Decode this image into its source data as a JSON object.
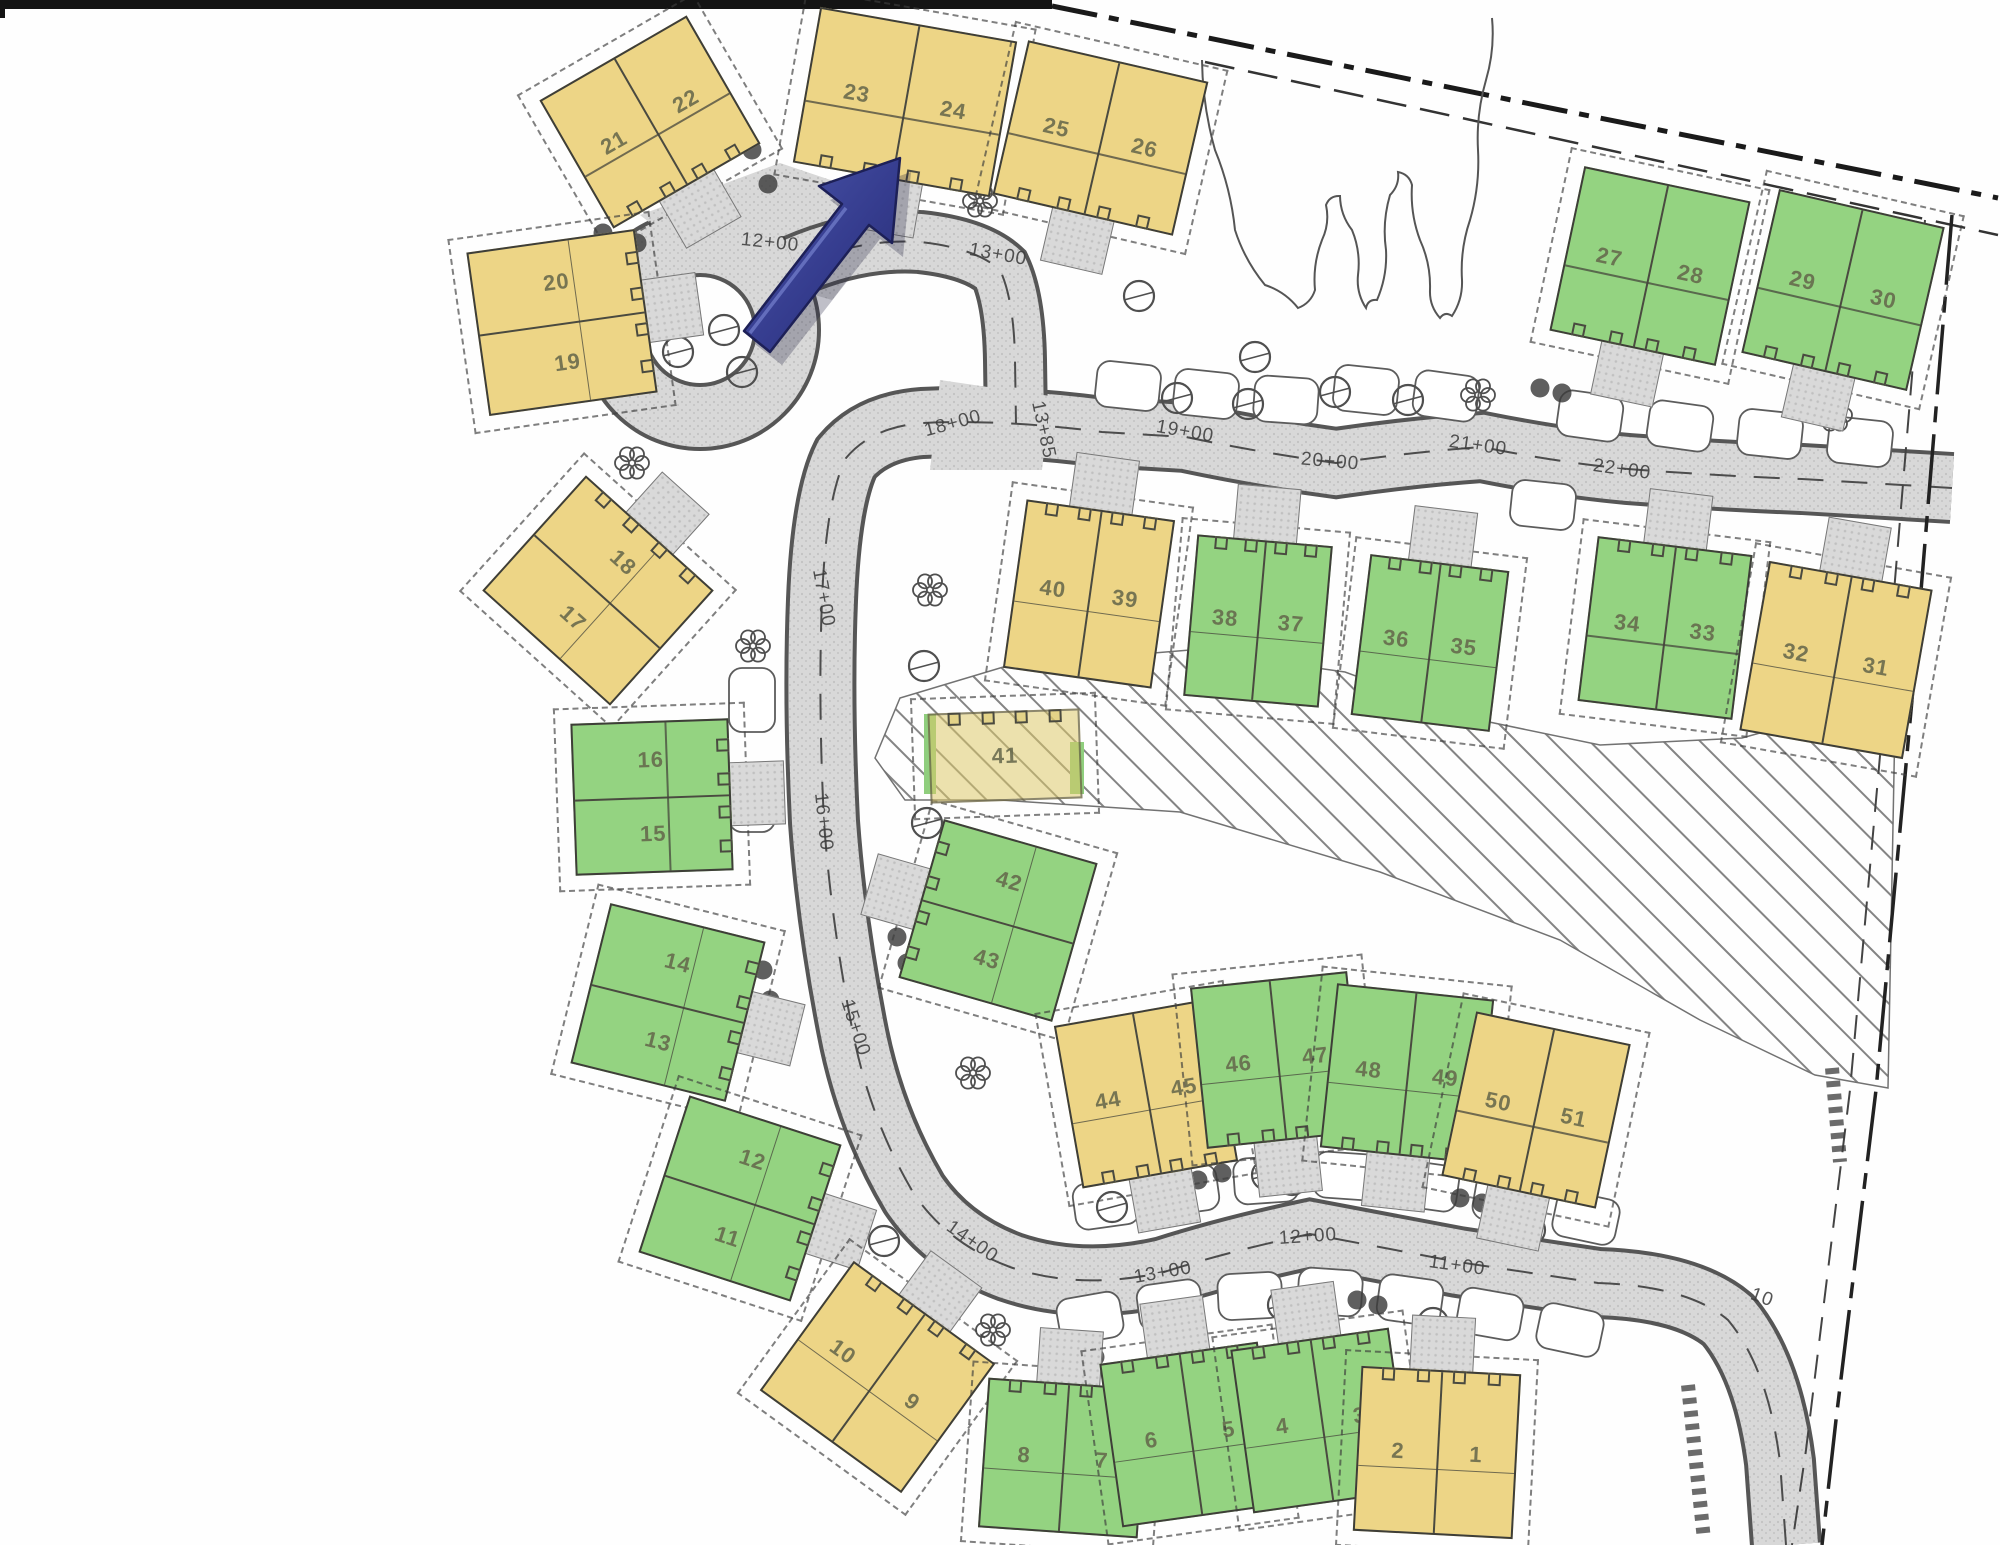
{
  "map": {
    "colors": {
      "lot_yellow": "#edd586",
      "lot_yellow_faded": "rgba(221,201,106,0.55)",
      "lot_green": "#94d381",
      "road_gray": "#d8d8d8",
      "outline_dark": "#3e3e38",
      "arrow_blue": "#3a418f",
      "boundary_black": "#161616"
    },
    "buildings": [
      {
        "id": "b21-22",
        "lots": [
          {
            "n": "21"
          },
          {
            "n": "22"
          }
        ],
        "color": "yellow",
        "cx": 650,
        "cy": 122,
        "w": 170,
        "h": 148,
        "rot": -30,
        "stack": "h",
        "drive": "bottom"
      },
      {
        "id": "b23-24",
        "lots": [
          {
            "n": "23"
          },
          {
            "n": "24"
          }
        ],
        "color": "yellow",
        "cx": 905,
        "cy": 102,
        "w": 200,
        "h": 158,
        "rot": 10,
        "stack": "h",
        "drive": "bottom"
      },
      {
        "id": "b25-26",
        "lots": [
          {
            "n": "25"
          },
          {
            "n": "26"
          }
        ],
        "color": "yellow",
        "cx": 1100,
        "cy": 138,
        "w": 185,
        "h": 158,
        "rot": 13,
        "stack": "h",
        "drive": "bottom"
      },
      {
        "id": "b27-28",
        "lots": [
          {
            "n": "27"
          },
          {
            "n": "28"
          }
        ],
        "color": "green",
        "cx": 1650,
        "cy": 266,
        "w": 170,
        "h": 168,
        "rot": 12,
        "stack": "h",
        "drive": "bottom"
      },
      {
        "id": "b29-30",
        "lots": [
          {
            "n": "29"
          },
          {
            "n": "30"
          }
        ],
        "color": "green",
        "cx": 1843,
        "cy": 290,
        "w": 170,
        "h": 168,
        "rot": 13,
        "stack": "h",
        "drive": "bottom"
      },
      {
        "id": "b20-19",
        "lots": [
          {
            "n": "20"
          },
          {
            "n": "19"
          }
        ],
        "color": "yellow",
        "cx": 562,
        "cy": 322,
        "w": 170,
        "h": 165,
        "rot": -8,
        "stack": "v",
        "drive": "right"
      },
      {
        "id": "b18-17",
        "lots": [
          {
            "n": "18"
          },
          {
            "n": "17"
          }
        ],
        "color": "yellow",
        "cx": 598,
        "cy": 590,
        "w": 172,
        "h": 155,
        "rot": 42,
        "stack": "v",
        "drive": "top"
      },
      {
        "id": "b16-15",
        "lots": [
          {
            "n": "16"
          },
          {
            "n": "15"
          }
        ],
        "color": "green",
        "cx": 652,
        "cy": 797,
        "w": 158,
        "h": 152,
        "rot": -2,
        "stack": "v",
        "drive": "right"
      },
      {
        "id": "b14-13",
        "lots": [
          {
            "n": "14"
          },
          {
            "n": "13"
          }
        ],
        "color": "green",
        "cx": 668,
        "cy": 1002,
        "w": 160,
        "h": 165,
        "rot": 14,
        "stack": "v",
        "drive": "right"
      },
      {
        "id": "b42-43",
        "lots": [
          {
            "n": "42"
          },
          {
            "n": "43"
          }
        ],
        "color": "green",
        "cx": 998,
        "cy": 920,
        "w": 160,
        "h": 165,
        "rot": 16,
        "stack": "v",
        "drive": "left"
      },
      {
        "id": "b12-11",
        "lots": [
          {
            "n": "12"
          },
          {
            "n": "11"
          }
        ],
        "color": "green",
        "cx": 740,
        "cy": 1198,
        "w": 160,
        "h": 165,
        "rot": 18,
        "stack": "v",
        "drive": "right"
      },
      {
        "id": "b10-9",
        "lots": [
          {
            "n": "10"
          },
          {
            "n": "9"
          }
        ],
        "color": "yellow",
        "cx": 877,
        "cy": 1377,
        "w": 175,
        "h": 160,
        "rot": 36,
        "stack": "h",
        "drive": "top"
      },
      {
        "id": "b40-39",
        "lots": [
          {
            "n": "40"
          },
          {
            "n": "39"
          }
        ],
        "color": "yellow",
        "cx": 1089,
        "cy": 594,
        "w": 150,
        "h": 170,
        "rot": 8,
        "stack": "h",
        "drive": "top"
      },
      {
        "id": "b38-37",
        "lots": [
          {
            "n": "38"
          },
          {
            "n": "37"
          }
        ],
        "color": "green",
        "cx": 1258,
        "cy": 621,
        "w": 136,
        "h": 162,
        "rot": 5,
        "stack": "h",
        "drive": "top"
      },
      {
        "id": "b36-35",
        "lots": [
          {
            "n": "36"
          },
          {
            "n": "35"
          }
        ],
        "color": "green",
        "cx": 1430,
        "cy": 643,
        "w": 140,
        "h": 162,
        "rot": 7,
        "stack": "h",
        "drive": "top"
      },
      {
        "id": "b34-33",
        "lots": [
          {
            "n": "34"
          },
          {
            "n": "33"
          }
        ],
        "color": "green",
        "cx": 1665,
        "cy": 628,
        "w": 156,
        "h": 166,
        "rot": 7,
        "stack": "h",
        "drive": "top"
      },
      {
        "id": "b32-31",
        "lots": [
          {
            "n": "32"
          },
          {
            "n": "31"
          }
        ],
        "color": "yellow",
        "cx": 1836,
        "cy": 660,
        "w": 166,
        "h": 172,
        "rot": 10,
        "stack": "h",
        "drive": "top"
      },
      {
        "id": "b41",
        "lots": [
          {
            "n": "41"
          }
        ],
        "color": "yellow_faded",
        "cx": 1005,
        "cy": 756,
        "w": 152,
        "h": 90,
        "rot": -2,
        "stack": "h",
        "drive": "none"
      },
      {
        "id": "b44-45",
        "lots": [
          {
            "n": "44"
          },
          {
            "n": "45"
          }
        ],
        "color": "yellow",
        "cx": 1146,
        "cy": 1093,
        "w": 158,
        "h": 165,
        "rot": -10,
        "stack": "h",
        "drive": "bottom"
      },
      {
        "id": "b46-47",
        "lots": [
          {
            "n": "46"
          },
          {
            "n": "47"
          }
        ],
        "color": "green",
        "cx": 1277,
        "cy": 1060,
        "w": 158,
        "h": 162,
        "rot": -6,
        "stack": "h",
        "drive": "bottom"
      },
      {
        "id": "b48-49",
        "lots": [
          {
            "n": "48"
          },
          {
            "n": "49"
          }
        ],
        "color": "green",
        "cx": 1407,
        "cy": 1073,
        "w": 158,
        "h": 165,
        "rot": 6,
        "stack": "h",
        "drive": "bottom"
      },
      {
        "id": "b50-51",
        "lots": [
          {
            "n": "50"
          },
          {
            "n": "51"
          }
        ],
        "color": "yellow",
        "cx": 1536,
        "cy": 1110,
        "w": 158,
        "h": 168,
        "rot": 12,
        "stack": "h",
        "drive": "bottom"
      },
      {
        "id": "b8-7",
        "lots": [
          {
            "n": "8"
          },
          {
            "n": "7"
          }
        ],
        "color": "green",
        "cx": 1063,
        "cy": 1458,
        "w": 160,
        "h": 150,
        "rot": 4,
        "stack": "h",
        "drive": "top"
      },
      {
        "id": "b6-5",
        "lots": [
          {
            "n": "6"
          },
          {
            "n": "5"
          }
        ],
        "color": "green",
        "cx": 1190,
        "cy": 1434,
        "w": 160,
        "h": 165,
        "rot": -8,
        "stack": "h",
        "drive": "top"
      },
      {
        "id": "b4-3",
        "lots": [
          {
            "n": "4"
          },
          {
            "n": "3"
          }
        ],
        "color": "green",
        "cx": 1321,
        "cy": 1420,
        "w": 160,
        "h": 165,
        "rot": -8,
        "stack": "h",
        "drive": "top"
      },
      {
        "id": "b2-1",
        "lots": [
          {
            "n": "2"
          },
          {
            "n": "1"
          }
        ],
        "color": "yellow",
        "cx": 1437,
        "cy": 1452,
        "w": 160,
        "h": 165,
        "rot": 3,
        "stack": "h",
        "drive": "top"
      }
    ],
    "stations": [
      {
        "label": "12+00",
        "x": 770,
        "y": 243,
        "r": 6
      },
      {
        "label": "13+00",
        "x": 998,
        "y": 255,
        "r": 10
      },
      {
        "label": "13+85",
        "x": 1043,
        "y": 430,
        "r": 78
      },
      {
        "label": "18+00",
        "x": 953,
        "y": 424,
        "r": -15
      },
      {
        "label": "19+00",
        "x": 1185,
        "y": 432,
        "r": 10
      },
      {
        "label": "20+00",
        "x": 1330,
        "y": 462,
        "r": 5
      },
      {
        "label": "21+00",
        "x": 1478,
        "y": 446,
        "r": 8
      },
      {
        "label": "22+00",
        "x": 1622,
        "y": 470,
        "r": 8
      },
      {
        "label": "17+00",
        "x": 823,
        "y": 598,
        "r": 80
      },
      {
        "label": "16+00",
        "x": 823,
        "y": 822,
        "r": 84
      },
      {
        "label": "15+00",
        "x": 855,
        "y": 1028,
        "r": 72
      },
      {
        "label": "14+00",
        "x": 972,
        "y": 1242,
        "r": 35
      },
      {
        "label": "13+00",
        "x": 1163,
        "y": 1273,
        "r": -10
      },
      {
        "label": "12+00",
        "x": 1308,
        "y": 1237,
        "r": -4
      },
      {
        "label": "11+00",
        "x": 1457,
        "y": 1266,
        "r": 8
      },
      {
        "label": "10",
        "x": 1762,
        "y": 1298,
        "r": 20
      }
    ],
    "trees": [
      {
        "t": "shrub",
        "x": 603,
        "y": 233
      },
      {
        "t": "shrub",
        "x": 637,
        "y": 243
      },
      {
        "t": "shrub",
        "x": 752,
        "y": 150
      },
      {
        "t": "shrub",
        "x": 768,
        "y": 184
      },
      {
        "t": "shrub",
        "x": 758,
        "y": 783
      },
      {
        "t": "shrub",
        "x": 762,
        "y": 813
      },
      {
        "t": "shrub",
        "x": 763,
        "y": 970
      },
      {
        "t": "shrub",
        "x": 770,
        "y": 1000
      },
      {
        "t": "shrub",
        "x": 897,
        "y": 937
      },
      {
        "t": "shrub",
        "x": 907,
        "y": 963
      },
      {
        "t": "shrub",
        "x": 1073,
        "y": 1353
      },
      {
        "t": "shrub",
        "x": 1095,
        "y": 1357
      },
      {
        "t": "shrub",
        "x": 1198,
        "y": 1180
      },
      {
        "t": "shrub",
        "x": 1222,
        "y": 1173
      },
      {
        "t": "shrub",
        "x": 1387,
        "y": 1172
      },
      {
        "t": "shrub",
        "x": 1408,
        "y": 1177
      },
      {
        "t": "shrub",
        "x": 1460,
        "y": 1198
      },
      {
        "t": "shrub",
        "x": 1482,
        "y": 1203
      },
      {
        "t": "shrub",
        "x": 1357,
        "y": 1300
      },
      {
        "t": "shrub",
        "x": 1378,
        "y": 1305
      },
      {
        "t": "shrub",
        "x": 1540,
        "y": 388
      },
      {
        "t": "shrub",
        "x": 1562,
        "y": 393
      },
      {
        "t": "circle",
        "x": 1139,
        "y": 296
      },
      {
        "t": "circle",
        "x": 1255,
        "y": 357
      },
      {
        "t": "circle",
        "x": 1177,
        "y": 398
      },
      {
        "t": "circle",
        "x": 1248,
        "y": 404
      },
      {
        "t": "circle",
        "x": 1335,
        "y": 392
      },
      {
        "t": "circle",
        "x": 1408,
        "y": 400
      },
      {
        "t": "circle",
        "x": 924,
        "y": 666
      },
      {
        "t": "circle",
        "x": 927,
        "y": 823
      },
      {
        "t": "circle",
        "x": 884,
        "y": 1241
      },
      {
        "t": "circle",
        "x": 1112,
        "y": 1207
      },
      {
        "t": "circle",
        "x": 1267,
        "y": 1175
      },
      {
        "t": "circle",
        "x": 1292,
        "y": 1180
      },
      {
        "t": "circle",
        "x": 1283,
        "y": 1305
      },
      {
        "t": "circle",
        "x": 1433,
        "y": 1323
      },
      {
        "t": "circle",
        "x": 678,
        "y": 352
      },
      {
        "t": "circle",
        "x": 724,
        "y": 330
      },
      {
        "t": "circle",
        "x": 742,
        "y": 372
      },
      {
        "t": "circle",
        "x": 1530,
        "y": 1230
      },
      {
        "t": "flower",
        "x": 980,
        "y": 201
      },
      {
        "t": "flower",
        "x": 930,
        "y": 590
      },
      {
        "t": "flower",
        "x": 753,
        "y": 646
      },
      {
        "t": "flower",
        "x": 973,
        "y": 1073
      },
      {
        "t": "flower",
        "x": 993,
        "y": 1330
      },
      {
        "t": "flower",
        "x": 1478,
        "y": 395
      },
      {
        "t": "flower",
        "x": 1835,
        "y": 415
      },
      {
        "t": "flower",
        "x": 632,
        "y": 463
      }
    ],
    "bays": [
      {
        "x": 1128,
        "y": 386,
        "r": 6
      },
      {
        "x": 1206,
        "y": 394,
        "r": 6
      },
      {
        "x": 1286,
        "y": 400,
        "r": 4
      },
      {
        "x": 1366,
        "y": 390,
        "r": 6
      },
      {
        "x": 1446,
        "y": 396,
        "r": 8
      },
      {
        "x": 1590,
        "y": 416,
        "r": 8
      },
      {
        "x": 1680,
        "y": 426,
        "r": 8
      },
      {
        "x": 1770,
        "y": 434,
        "r": 6
      },
      {
        "x": 1860,
        "y": 442,
        "r": 6
      },
      {
        "x": 1543,
        "y": 505,
        "r": 6
      },
      {
        "x": 752,
        "y": 700,
        "r": 90
      },
      {
        "x": 752,
        "y": 800,
        "r": 90
      },
      {
        "x": 1106,
        "y": 1204,
        "r": -8
      },
      {
        "x": 1186,
        "y": 1190,
        "r": -8
      },
      {
        "x": 1266,
        "y": 1180,
        "r": -4
      },
      {
        "x": 1346,
        "y": 1176,
        "r": 4
      },
      {
        "x": 1426,
        "y": 1186,
        "r": 8
      },
      {
        "x": 1506,
        "y": 1200,
        "r": 10
      },
      {
        "x": 1586,
        "y": 1218,
        "r": 12
      },
      {
        "x": 1090,
        "y": 1318,
        "r": -10
      },
      {
        "x": 1170,
        "y": 1305,
        "r": -8
      },
      {
        "x": 1250,
        "y": 1296,
        "r": -3
      },
      {
        "x": 1330,
        "y": 1292,
        "r": 4
      },
      {
        "x": 1410,
        "y": 1300,
        "r": 8
      },
      {
        "x": 1490,
        "y": 1314,
        "r": 10
      },
      {
        "x": 1570,
        "y": 1330,
        "r": 12
      }
    ],
    "forest": [
      [
        1202,
        60
      ],
      [
        1215,
        150
      ],
      [
        1235,
        230
      ],
      [
        1265,
        285
      ],
      [
        1298,
        308
      ],
      [
        1315,
        290
      ],
      [
        1322,
        240
      ],
      [
        1326,
        205
      ],
      [
        1340,
        196
      ],
      [
        1352,
        230
      ],
      [
        1358,
        275
      ],
      [
        1366,
        308
      ],
      [
        1377,
        300
      ],
      [
        1386,
        250
      ],
      [
        1390,
        195
      ],
      [
        1398,
        172
      ],
      [
        1412,
        185
      ],
      [
        1420,
        240
      ],
      [
        1430,
        290
      ],
      [
        1440,
        318
      ],
      [
        1452,
        316
      ],
      [
        1462,
        280
      ],
      [
        1470,
        220
      ],
      [
        1478,
        150
      ],
      [
        1486,
        80
      ],
      [
        1492,
        18
      ]
    ]
  }
}
